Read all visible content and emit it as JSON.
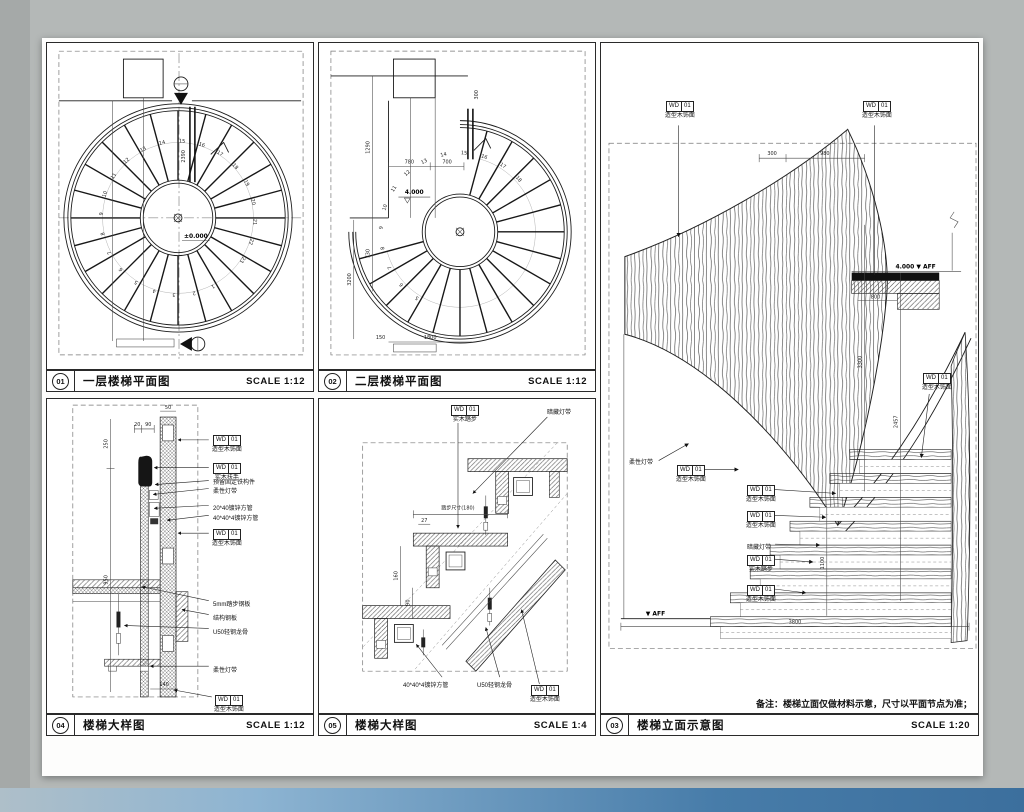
{
  "tag": {
    "code": "WD",
    "num": "01"
  },
  "materials": {
    "wood_shaped": "造型木饰面",
    "wood_handrail": "实木扶手",
    "wood_tread": "实木踏步",
    "flex_strip": "柔性灯带",
    "hidden_strip": "暗藏灯带",
    "embed_part": "预留固定铁构件",
    "tube_2040": "20*40镀锌方管",
    "tube_4040": "40*40*4镀锌方管",
    "plate_5mm": "5mm踏步钢板",
    "plate_struct": "结构钢板",
    "keel_u50": "U50轻钢龙骨"
  },
  "panels": {
    "p1": {
      "num": "01",
      "title": "一层楼梯平面图",
      "scale": "SCALE 1:12",
      "level": "±0.000",
      "dim_2390": "2390",
      "tread_numbers": [
        "1",
        "2",
        "3",
        "4",
        "5",
        "6",
        "7",
        "8",
        "9",
        "10",
        "11",
        "12",
        "13",
        "14",
        "15",
        "16",
        "17",
        "18",
        "19",
        "20",
        "21",
        "22",
        "23"
      ]
    },
    "p2": {
      "num": "02",
      "title": "二层楼梯平面图",
      "scale": "SCALE 1:12",
      "level": "4.000",
      "dims": {
        "d1290": "1290",
        "d780": "780",
        "d700": "700",
        "d730": "730",
        "d3200": "3200",
        "d1800": "1800",
        "d150": "150",
        "d300": "300"
      },
      "tread_numbers": [
        "5",
        "6",
        "7",
        "8",
        "9",
        "10",
        "11",
        "12",
        "13",
        "14",
        "15",
        "16",
        "17",
        "18"
      ]
    },
    "p3": {
      "num": "03",
      "title": "楼梯立面示意图",
      "scale": "SCALE 1:20",
      "note": "备注：楼梯立面仅做材料示意，尺寸以平面节点为准；",
      "level_top": "4.000 ▼ AFF",
      "aff_bottom": "▼ AFF",
      "dims": {
        "d300": "300",
        "d980": "980",
        "d800": "800",
        "d3300": "3300",
        "d2457": "2457",
        "d1100": "1100",
        "d3800": "3800"
      }
    },
    "p4": {
      "num": "04",
      "title": "楼梯大样图",
      "scale": "SCALE 1:12",
      "dims": {
        "d250": "250",
        "d950": "950",
        "d20": "20",
        "d90": "90",
        "d50": "50",
        "d140": "140"
      }
    },
    "p5": {
      "num": "05",
      "title": "楼梯大样图",
      "scale": "SCALE 1:4",
      "dims": {
        "tread_note": "踏步尺寸(180)",
        "d27": "27",
        "d160": "160",
        "d90": "90"
      }
    }
  }
}
